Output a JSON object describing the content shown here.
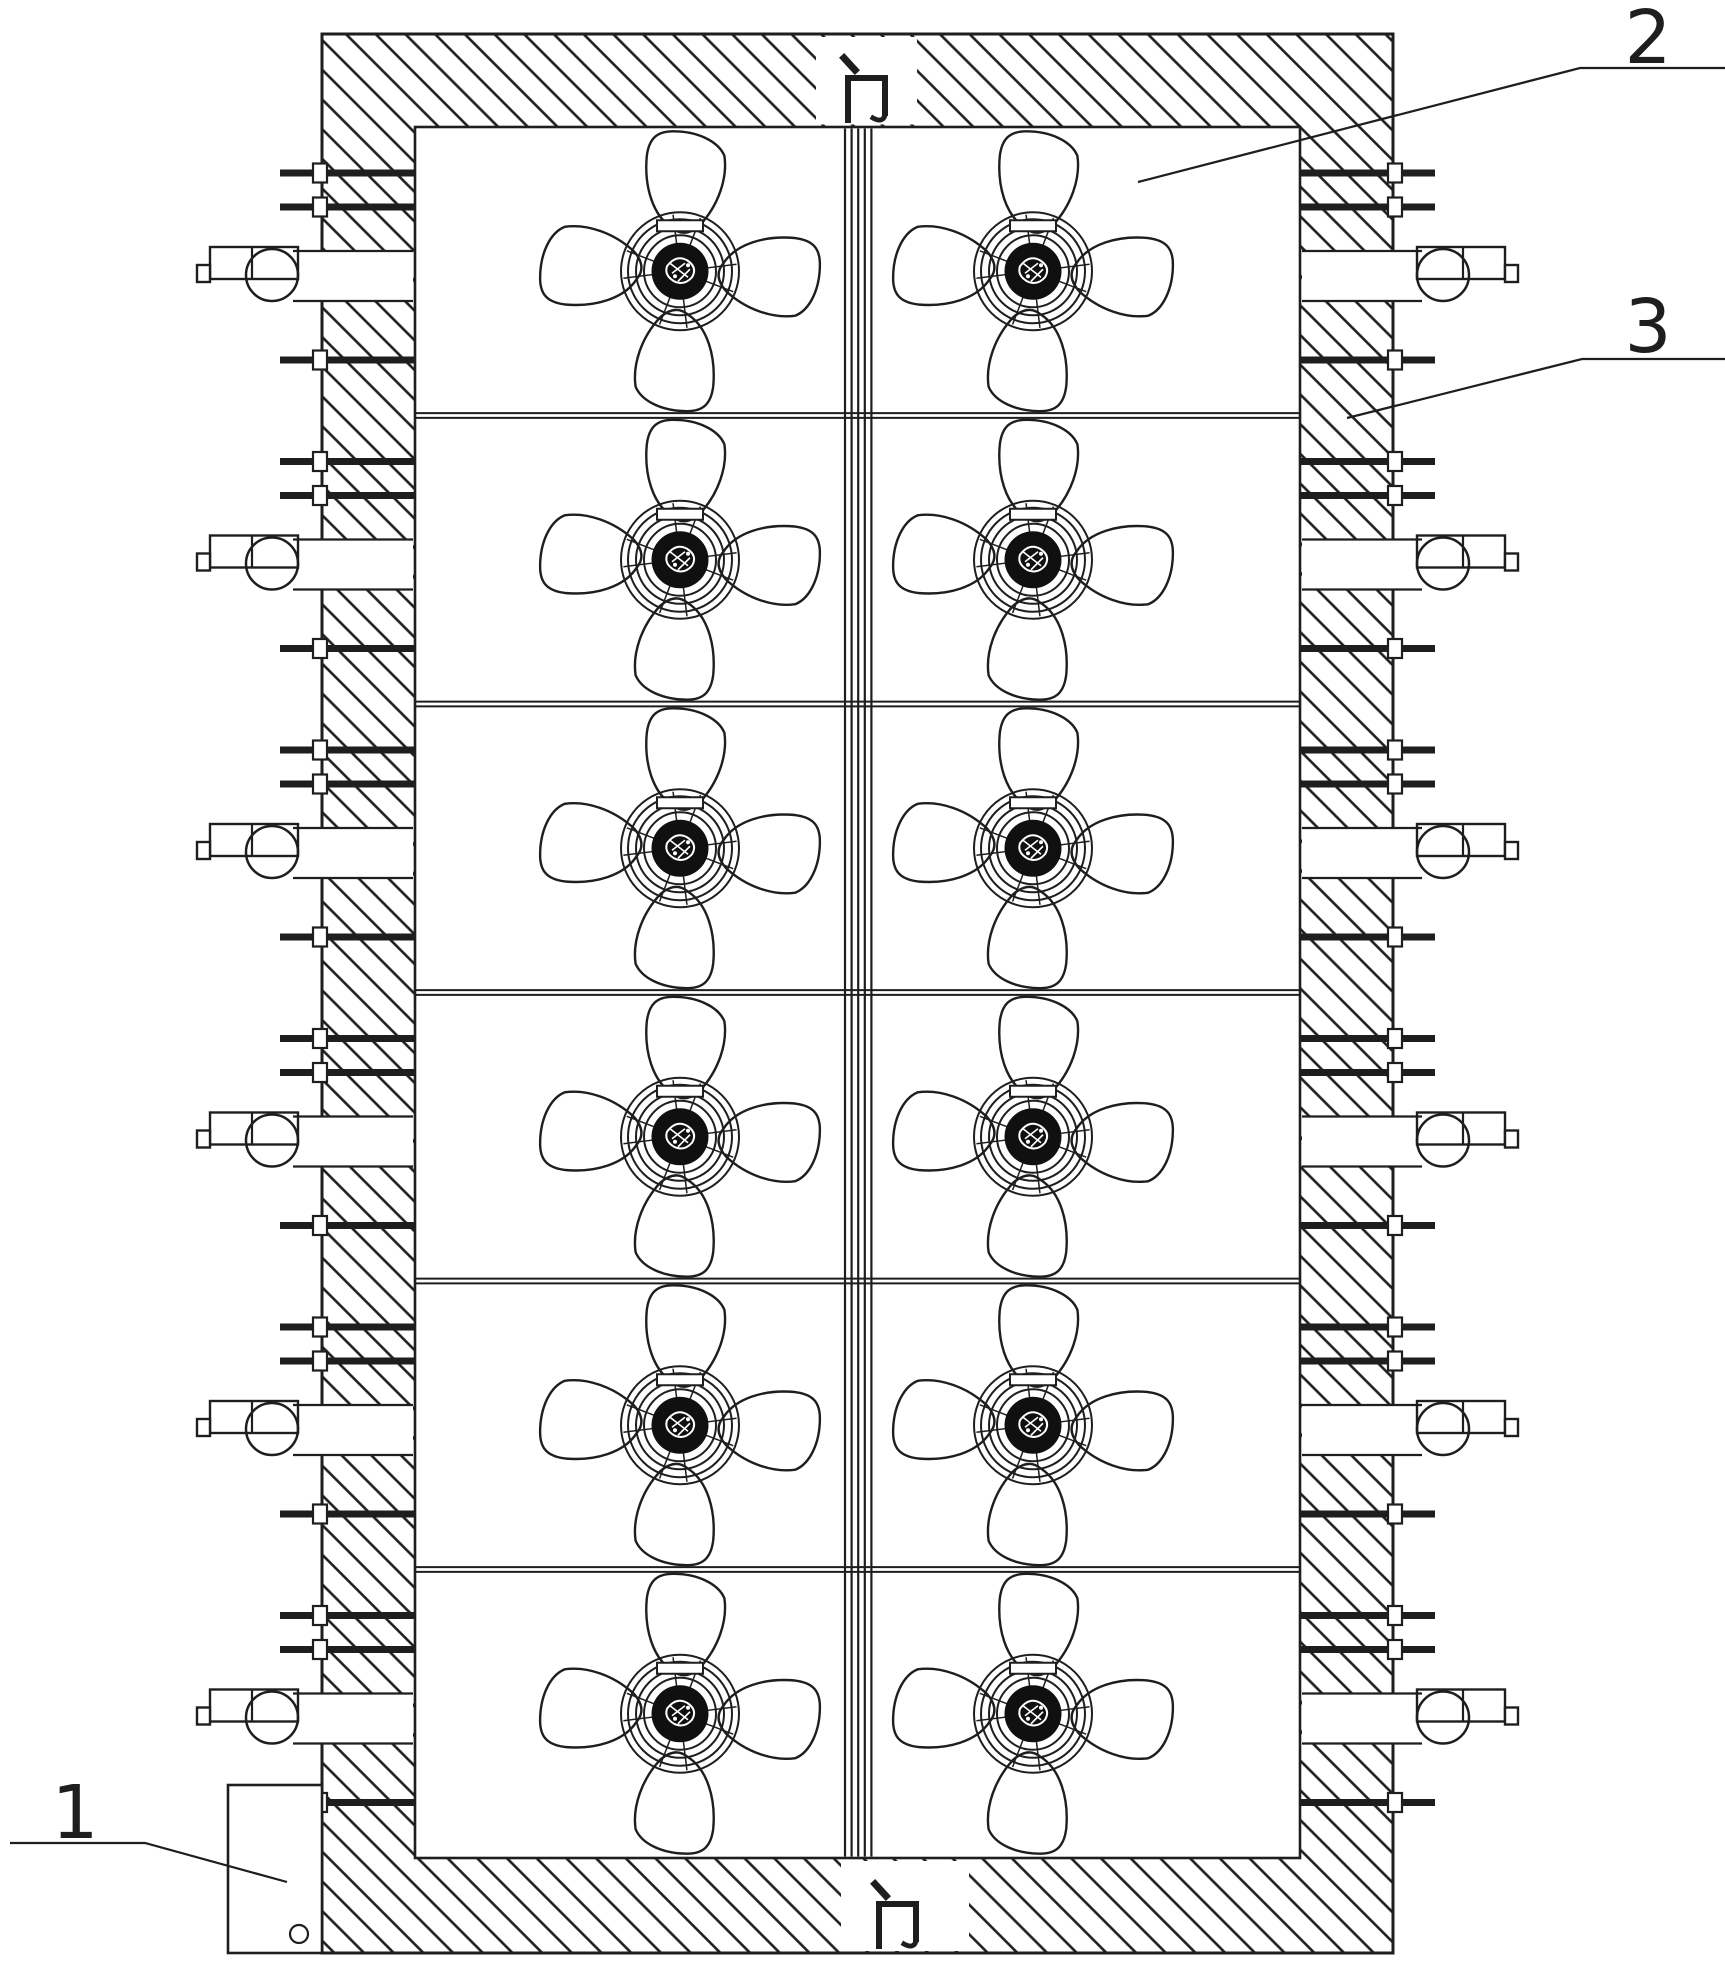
{
  "figure": {
    "title": "drying-room-plan-view",
    "ink": "#1e1e1e",
    "background": "#ffffff",
    "canvas": {
      "w": 1725,
      "h": 1967
    },
    "doors": {
      "top": "门",
      "bottom": "门"
    },
    "reference_labels": [
      {
        "id": "1",
        "text": "1",
        "points_to": "control-box"
      },
      {
        "id": "2",
        "text": "2",
        "points_to": "chamber-interior"
      },
      {
        "id": "3",
        "text": "3",
        "points_to": "insulated-wall"
      }
    ],
    "components": {
      "circulation_fans": 12,
      "fan_rows": 6,
      "fan_columns": 2,
      "heating_rollers_per_row_per_side": 6,
      "valves_per_side": 6,
      "pipes_per_row_per_side": 3
    },
    "geometry": {
      "frame": {
        "x": 322,
        "y": 34,
        "w": 1071,
        "h": 1919
      },
      "chamber": {
        "x": 415,
        "y": 127,
        "w": 885,
        "h": 1731
      },
      "mirror_2x": 1715,
      "rows": {
        "count": 6,
        "top": 127,
        "height": 288.5
      },
      "door_top": {
        "x": 816,
        "w": 101,
        "gx": 836,
        "gy": 56
      },
      "door_bottom": {
        "x": 841,
        "w": 128,
        "gx": 867,
        "gy": 1882
      },
      "pipes": {
        "tip_x": 280,
        "long_end": 509,
        "short_end": 416,
        "dy": [
          46,
          80,
          233
        ],
        "short_idx": 1,
        "width": 7
      },
      "flange": {
        "x": 313,
        "w": 14,
        "h": 19
      },
      "valve": {
        "cx": 272,
        "dy": 148,
        "r": 26,
        "rect_x": 210,
        "rect_w": 88,
        "rect_h": 32,
        "tab_x": 197,
        "tab_w": 13,
        "tab_h": 17,
        "vline_x": 252
      },
      "notch": {
        "x1": 293,
        "x2": 413,
        "dy1": 124,
        "dy2": 174
      },
      "rollers": {
        "cx": 462,
        "first_dy": 27,
        "step": 46.8,
        "count": 6,
        "r_outer": 18,
        "r_mid": 10.5,
        "r_dot": 5
      },
      "partition_x": [
        508.5,
        518.5
      ],
      "center_divider": {
        "x0": 845,
        "step": 6.6,
        "count": 5
      },
      "fans": {
        "cx": [
          680,
          1033
        ],
        "center_dy": 144.25
      },
      "row_divider": {
        "x1": 416,
        "x2": 1299,
        "gap": 4.8
      },
      "control_box": {
        "x": 228,
        "y": 1785,
        "w": 94,
        "h": 168,
        "hole_cx": 299,
        "hole_cy": 1934,
        "hole_r": 9
      },
      "leaders": {
        "l1": {
          "points": "10,1843 145,1843 287,1882",
          "tx": 75,
          "ty": 1838
        },
        "l2": {
          "points": "1725,68 1580,68 1138,182",
          "tx": 1648,
          "ty": 63
        },
        "l3": {
          "points": "1725,359 1582,359 1347,418",
          "tx": 1648,
          "ty": 352
        }
      }
    }
  }
}
